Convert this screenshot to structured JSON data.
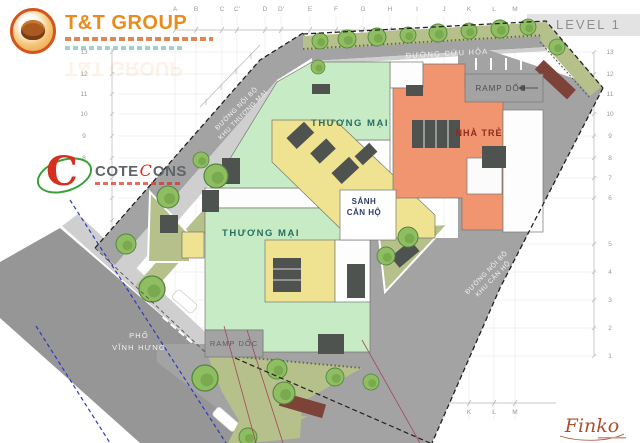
{
  "title": {
    "level_label": "LEVEL 1"
  },
  "logos": {
    "tt_group": {
      "name": "T&T GROUP"
    },
    "coteccons": {
      "pre": "COTE",
      "mid": "C",
      "post": "ONS"
    }
  },
  "plan_labels": {
    "thuong_mai_upper": "THƯƠNG MẠI",
    "thuong_mai_lower": "THƯƠNG MẠI",
    "nha_tre": "NHÀ TRẺ",
    "sanh_line1": "SẢNH",
    "sanh_line2": "CĂN HỘ",
    "ramp_doc_top": "RAMP DỐC",
    "ramp_doc_bottom": "RAMP DỐC"
  },
  "road_labels": {
    "duong_cuu_hoa": "ĐƯỜNG CỨU HỎA",
    "noi_bo_tm_line1": "ĐƯỜNG NỘI BỘ",
    "noi_bo_tm_line2": "KHU THƯƠNG MẠI",
    "noi_bo_ch_line1": "ĐƯỜNG NỘI BỘ",
    "noi_bo_ch_line2": "KHU CĂN HỘ",
    "pho_line1": "PHỐ",
    "pho_line2": "VĨNH HƯNG"
  },
  "grid": {
    "top_letters": [
      "A",
      "B",
      "C",
      "C'",
      "D",
      "D'",
      "E",
      "F",
      "G",
      "H",
      "I",
      "J",
      "K",
      "L",
      "M"
    ],
    "bottom_letters": [
      "E",
      "F",
      "G",
      "H",
      "I",
      "J",
      "K",
      "L",
      "M"
    ],
    "right_numbers": [
      "13",
      "12",
      "11",
      "10",
      "9",
      "8",
      "7",
      "6",
      "5",
      "4",
      "3",
      "2",
      "1"
    ],
    "left_numbers": [
      "13",
      "12",
      "11",
      "10",
      "9",
      "8"
    ]
  },
  "signature": "Finko",
  "colors": {
    "road": "#a3a3a3",
    "sidewalk": "#cfcfcf",
    "street": "#969696",
    "commercial_green": "#c7ecc5",
    "core_yellow": "#efe391",
    "kindergarten_orange": "#f19470",
    "grass": "#b5c08a",
    "tree": "#8fbd62",
    "boundary_blue": "#2a3bc0",
    "label_teal": "#256e62",
    "label_red": "#8f2a1a",
    "label_navy": "#2e3e66",
    "signature_red": "#ad4f2c",
    "banner_gray": "#e3e3e3",
    "core_dark": "#4f5350",
    "planter_brown": "#7d4338"
  }
}
